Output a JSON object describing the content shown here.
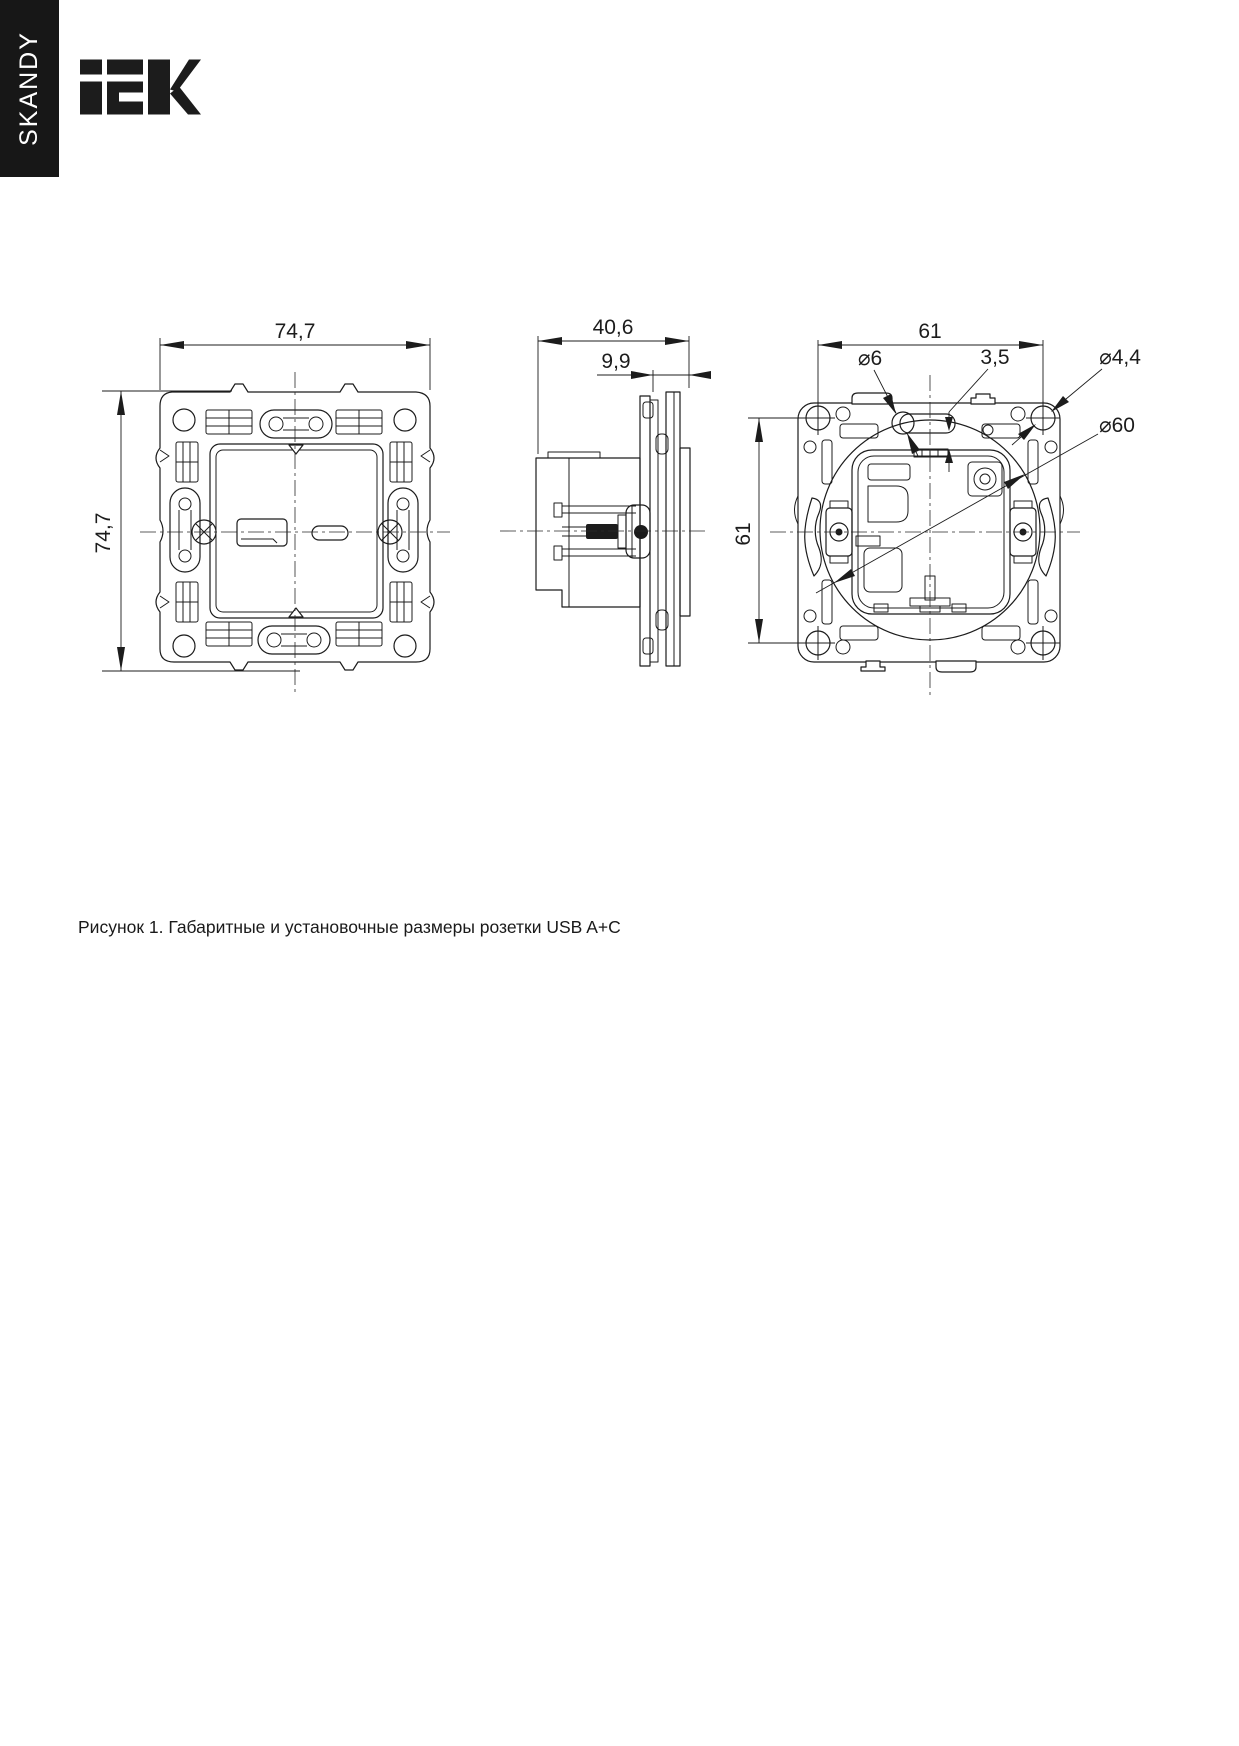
{
  "sidebar": {
    "series_label": "SKANDY"
  },
  "brand": {
    "name": "IEK"
  },
  "figure": {
    "caption": "Рисунок 1. Габаритные и установочные размеры розетки USB A+C",
    "views": {
      "front": {
        "width_label": "74,7",
        "height_label": "74,7"
      },
      "side": {
        "depth_label": "40,6",
        "protrusion_label": "9,9"
      },
      "back": {
        "hole_spacing_h_label": "61",
        "hole_spacing_v_label": "61",
        "tab_hole_dia_label": "⌀6",
        "tab_gap_label": "3,5",
        "screw_hole_dia_label": "⌀4,4",
        "mech_dia_label": "⌀60"
      }
    }
  },
  "colors": {
    "line": "#1c1c1c",
    "sidebar_bg": "#171717",
    "page_bg": "#ffffff",
    "text": "#1a1a1a"
  }
}
